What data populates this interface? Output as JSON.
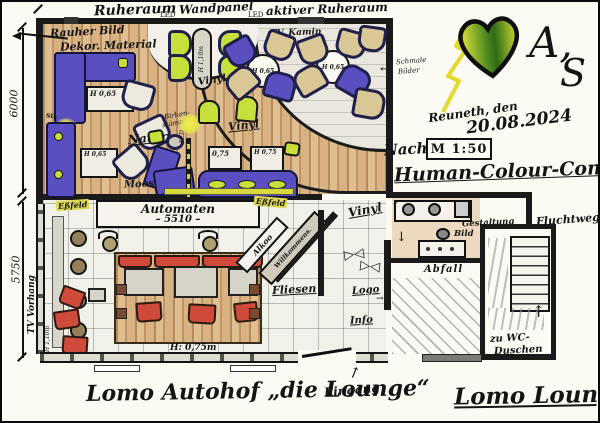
{
  "colors": {
    "paper": "#fbfaf3",
    "ink": "#1a1a1a",
    "wood": "#d4ae7e",
    "purple": "#5a4fc0",
    "green": "#c6df3a",
    "red": "#cf4a3a",
    "stone": "#e9e7de",
    "yellow": "#e4dc3a"
  },
  "header": {
    "ruheraum": "Ruheraum",
    "led_left": "LED",
    "wandpanel": "Wandpanel",
    "led_right": "LED",
    "aktiver_ruheraum": "aktiver Ruheraum"
  },
  "corner_art": {
    "initial_a": "A,",
    "initial_s": "S",
    "heart_icon": "heart"
  },
  "title_block": {
    "place_date": "Reuneth, den",
    "date": "20.08.2024",
    "scale": "M 1:50",
    "nach": "Nach:",
    "concept": "Human-Colour-Concept"
  },
  "dimensions": {
    "height_upper": "6000",
    "height_lower": "5750",
    "automat_width": "– 5510 –"
  },
  "ruheraum": {
    "rauher_bild": "Rauher Bild",
    "dekor_material": "Dekor. Material",
    "tv_kamin": "TV. Kamin",
    "schmale_1": "Schmale",
    "schmale_2": "Bilder",
    "natur": "Natur",
    "moos": "Moos",
    "birken_1": "Birken-",
    "birken_2": "stämme",
    "led": "LED",
    "stl": "StL",
    "vinyl": "Vinyl",
    "h065": "H 0,65",
    "h075": "0,75",
    "h075h": "H 0,75",
    "h110": "H 1,10m"
  },
  "gastraum": {
    "automaten": "Automaten",
    "essfeld": "Eßfeld",
    "tv_vorhang": "TV Vorhang",
    "h075m": "H: 0,75m",
    "h110": "H 1,10m",
    "alkoo": "Alkoo",
    "willkommen": "Willkommens.",
    "fliesen": "Fliesen",
    "eingang": "Eingang"
  },
  "service": {
    "logo": "Logo",
    "info": "Info",
    "abfall": "Abfall",
    "bild": "Bild",
    "gestaltung": "Gestaltung",
    "fluchtweg": "Fluchtweg",
    "wc_1": "zu WC-",
    "wc_2": "Duschen"
  },
  "footer": {
    "title_left": "Lomo Autohof „die Lounge“",
    "title_right": "Lomo Lounge"
  }
}
